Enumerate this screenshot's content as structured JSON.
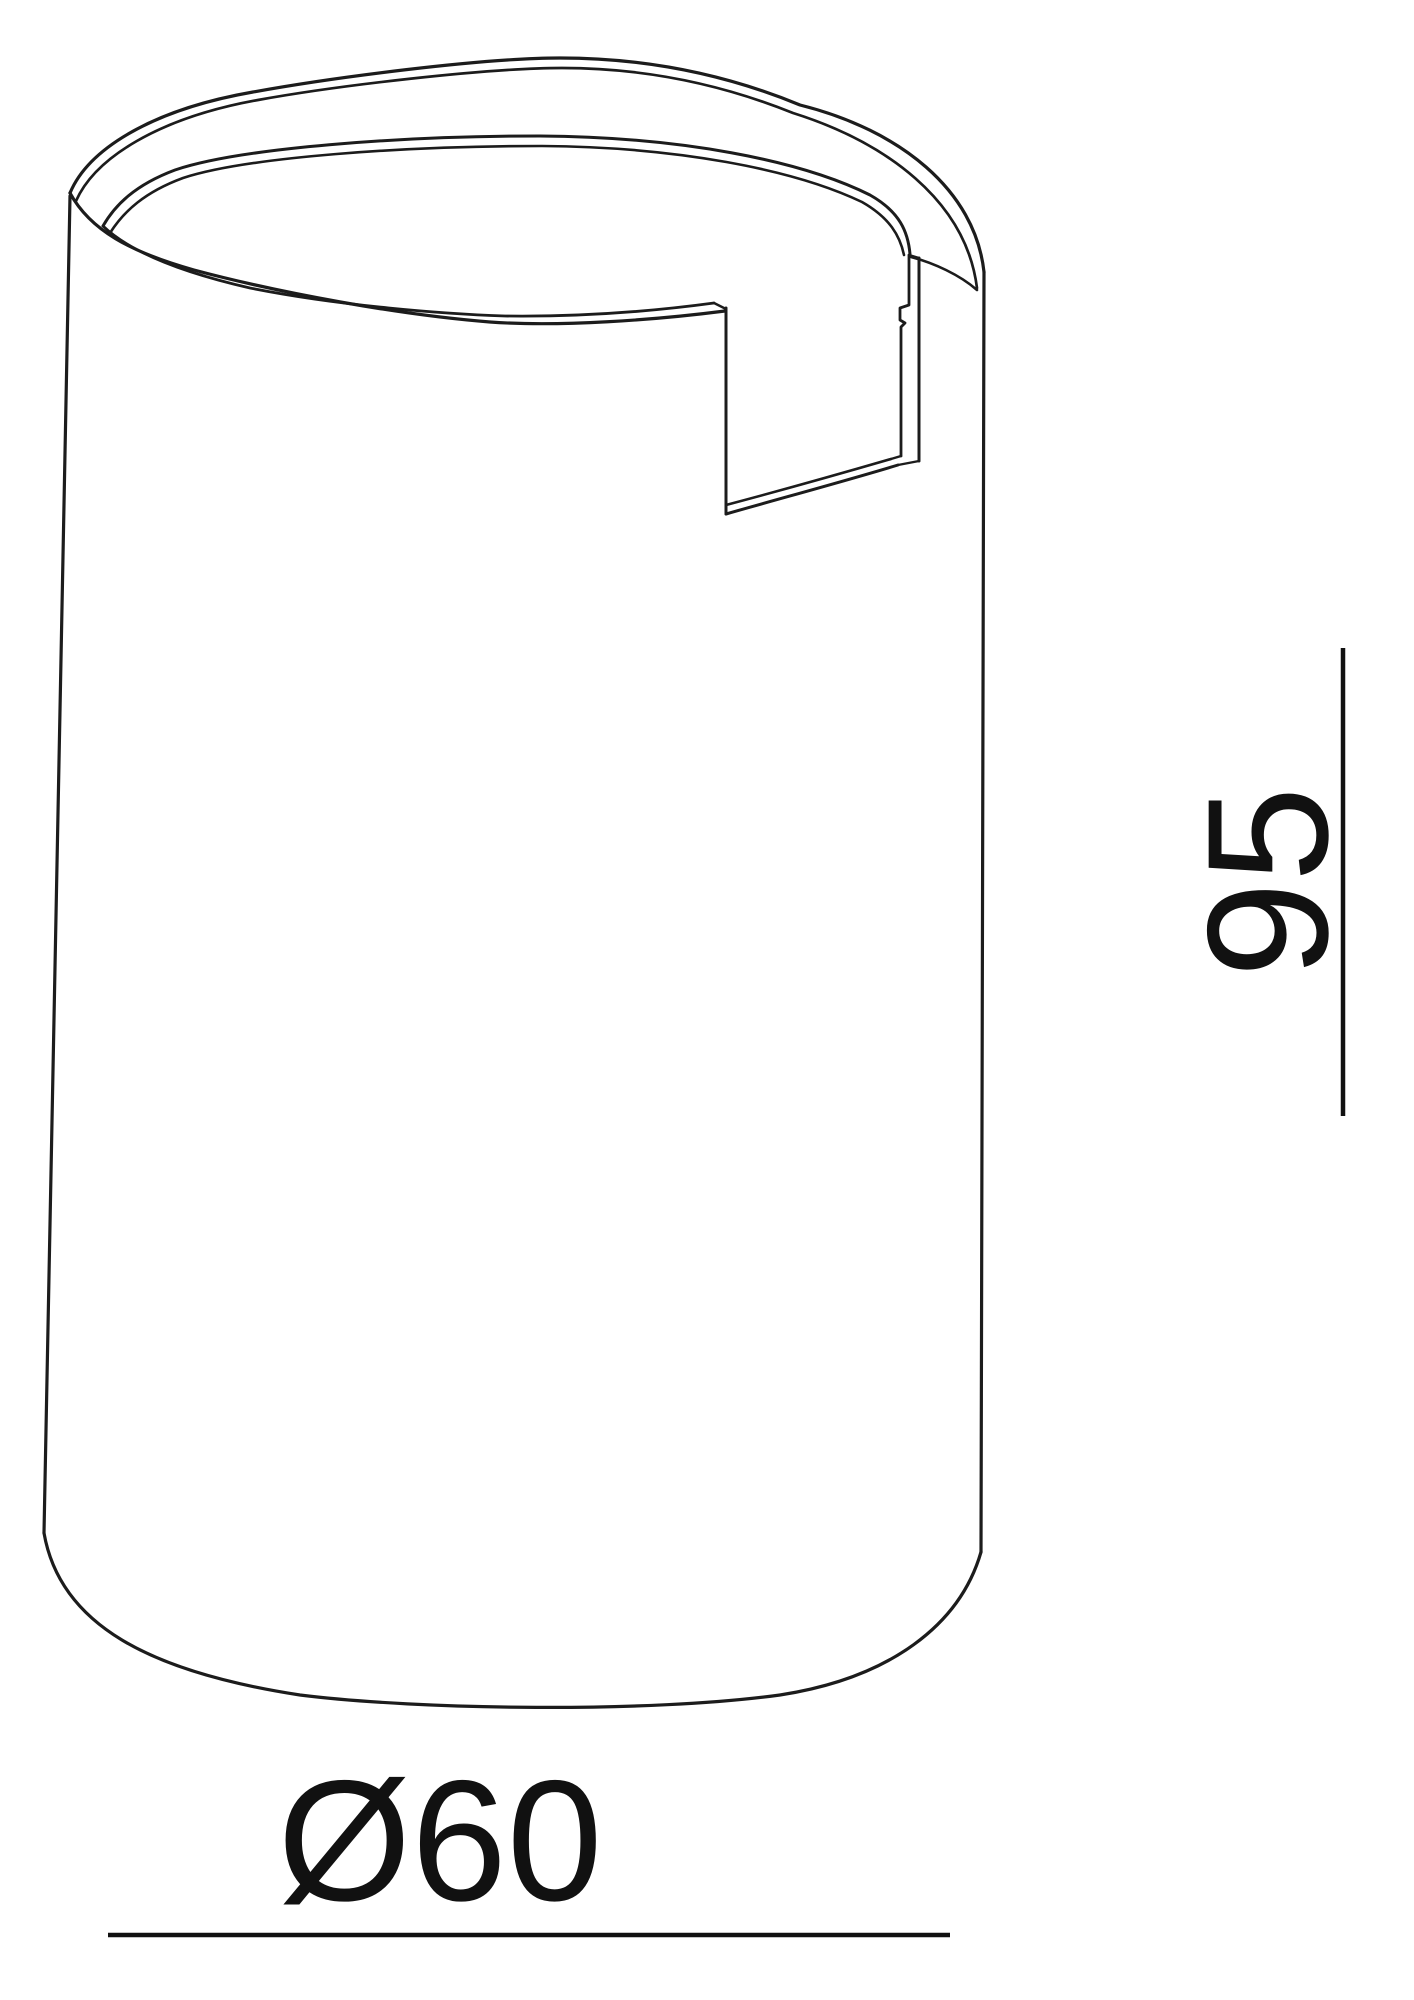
{
  "page": {
    "background_color": "#ffffff",
    "kind": "technical line drawing"
  },
  "drawing": {
    "subject": "cylinder-with-notch-cutout",
    "view": "perspective from above",
    "line_color": "#1c1c1c",
    "dimension_line_color": "#111111",
    "dimensions": {
      "height": {
        "label": "95",
        "orientation": "vertical, text rotated 90° reading bottom-to-top",
        "side": "right"
      },
      "diameter": {
        "label": "Ø60",
        "orientation": "horizontal",
        "side": "bottom"
      }
    }
  }
}
